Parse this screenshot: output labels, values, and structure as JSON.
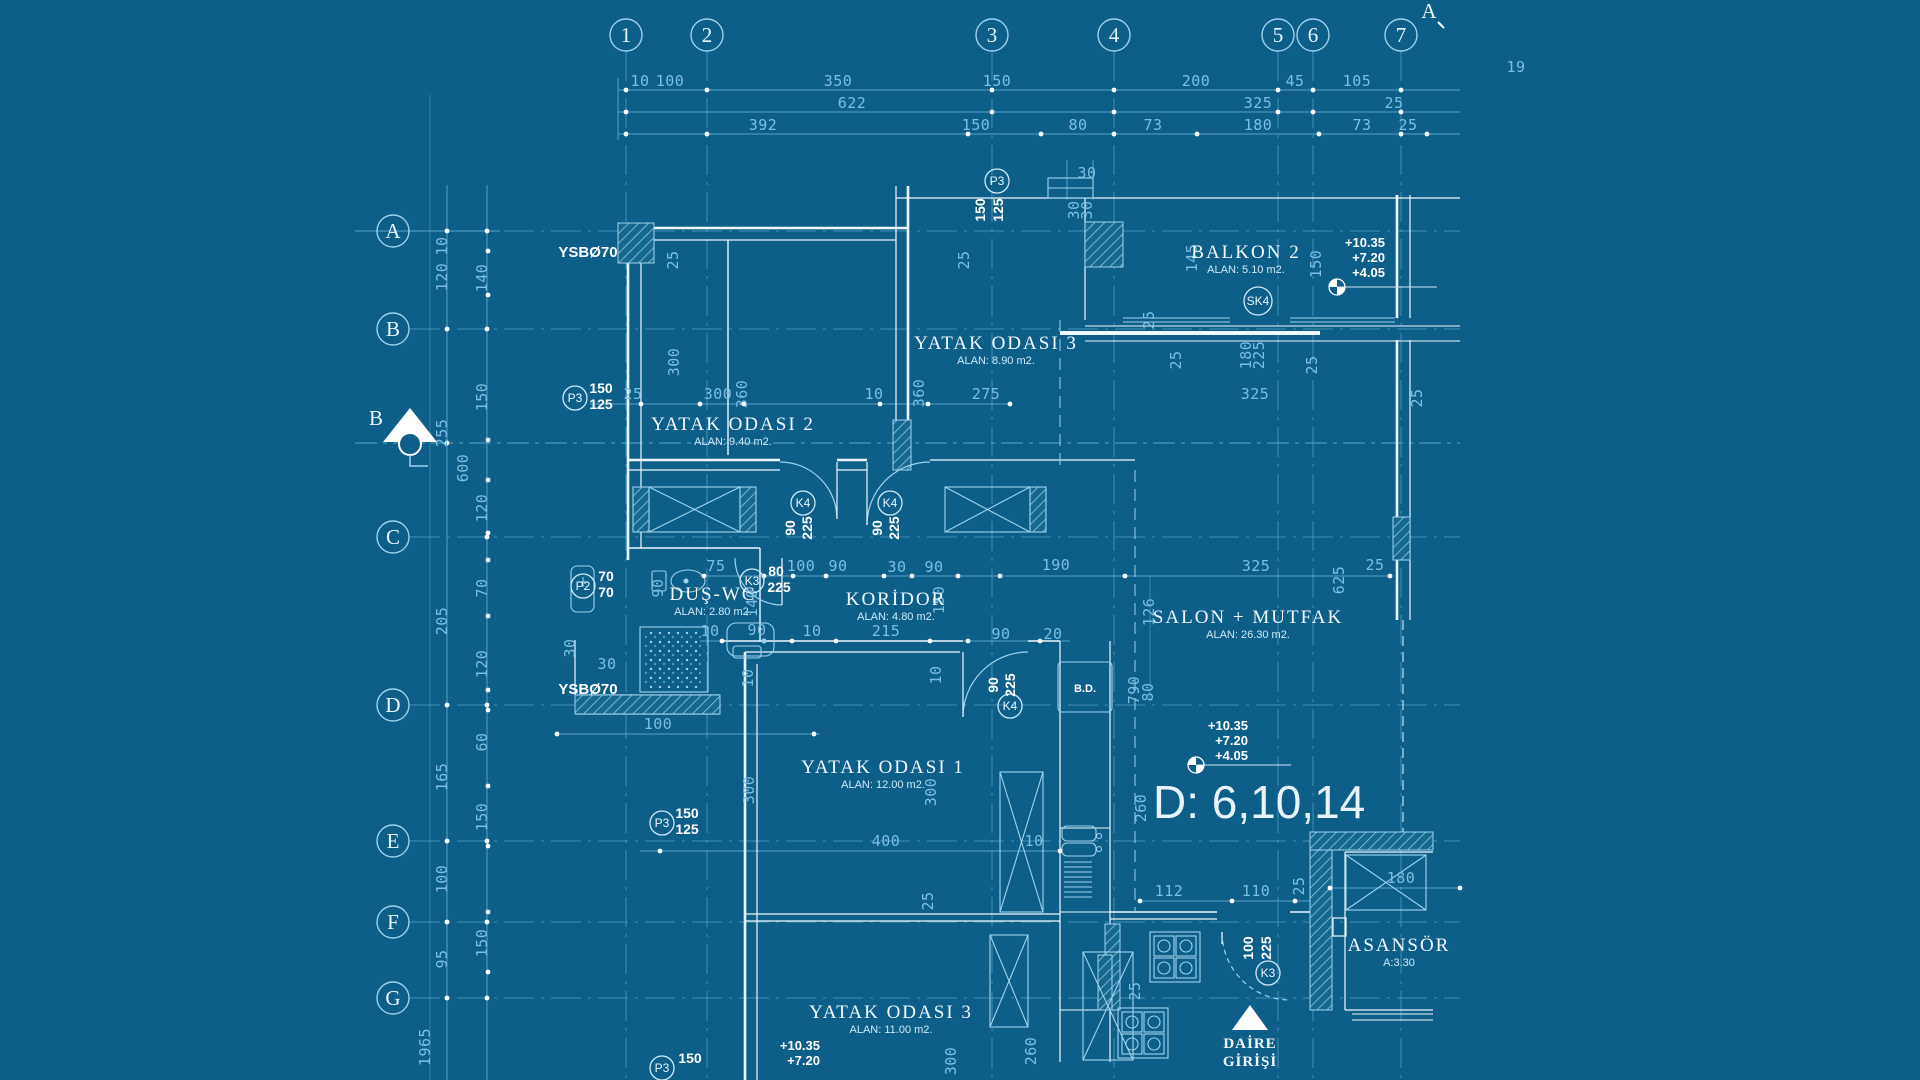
{
  "colors": {
    "background": "#0d5f8a",
    "pale_line": "#5fa8d0",
    "bright_line": "#9fd2ee",
    "wall": "#edf7ff",
    "dim_text": "#7cbee2",
    "label_text": "#f4faff",
    "hatch": "#8cc6e6"
  },
  "grid": {
    "columns": [
      {
        "label": "1",
        "x": 626
      },
      {
        "label": "2",
        "x": 707
      },
      {
        "label": "3",
        "x": 992
      },
      {
        "label": "4",
        "x": 1114
      },
      {
        "label": "5",
        "x": 1278
      },
      {
        "label": "6",
        "x": 1313
      },
      {
        "label": "7",
        "x": 1401
      }
    ],
    "rows": [
      {
        "label": "A",
        "y": 231
      },
      {
        "label": "B",
        "y": 329
      },
      {
        "label": "C",
        "y": 537
      },
      {
        "label": "D",
        "y": 705
      },
      {
        "label": "E",
        "y": 841
      },
      {
        "label": "F",
        "y": 922
      },
      {
        "label": "G",
        "y": 998
      }
    ]
  },
  "section_markers": [
    {
      "label": "B",
      "x": 383,
      "y": 422
    },
    {
      "label": "A",
      "x": 1429,
      "y": 14
    }
  ],
  "rooms": [
    {
      "name": "YATAK  ODASI 3",
      "area": "ALAN: 8.90 m2.",
      "x": 996,
      "y": 349
    },
    {
      "name": "YATAK  ODASI 2",
      "area": "ALAN: 9.40 m2.",
      "x": 733,
      "y": 430
    },
    {
      "name": "BALKON  2",
      "area": "ALAN: 5.10 m2.",
      "x": 1246,
      "y": 258
    },
    {
      "name": "DUŞ-WC",
      "area": "ALAN: 2.80 m2.",
      "x": 713,
      "y": 600
    },
    {
      "name": "KORİDOR",
      "area": "ALAN: 4.80 m2.",
      "x": 896,
      "y": 605
    },
    {
      "name": "SALON + MUTFAK",
      "area": "ALAN: 26.30 m2.",
      "x": 1248,
      "y": 623
    },
    {
      "name": "YATAK  ODASI 1",
      "area": "ALAN: 12.00 m2.",
      "x": 883,
      "y": 773
    },
    {
      "name": "YATAK  ODASI 3",
      "area": "ALAN: 11.00 m2.",
      "x": 891,
      "y": 1018
    },
    {
      "name": "ASANSÖR",
      "area": "A:3.30",
      "x": 1399,
      "y": 951
    }
  ],
  "tags": [
    {
      "label": "P3",
      "x": 997,
      "y": 181,
      "values": [
        {
          "t": "150",
          "x": 985,
          "y": 210,
          "r": -90
        },
        {
          "t": "125",
          "x": 1003,
          "y": 210,
          "r": -90
        }
      ]
    },
    {
      "label": "P3",
      "x": 575,
      "y": 398,
      "values": [
        {
          "t": "150",
          "x": 601,
          "y": 393,
          "r": 0
        },
        {
          "t": "125",
          "x": 601,
          "y": 409,
          "r": 0
        }
      ]
    },
    {
      "label": "P2",
      "x": 583,
      "y": 586,
      "values": [
        {
          "t": "70",
          "x": 606,
          "y": 581,
          "r": 0
        },
        {
          "t": "70",
          "x": 606,
          "y": 597,
          "r": 0
        }
      ]
    },
    {
      "label": "K3",
      "x": 752,
      "y": 581,
      "values": [
        {
          "t": "80",
          "x": 776,
          "y": 576,
          "r": 0
        },
        {
          "t": "225",
          "x": 779,
          "y": 592,
          "r": 0
        }
      ]
    },
    {
      "label": "K4",
      "x": 803,
      "y": 503,
      "values": [
        {
          "t": "90",
          "x": 795,
          "y": 528,
          "r": -90
        },
        {
          "t": "225",
          "x": 812,
          "y": 528,
          "r": -90
        }
      ]
    },
    {
      "label": "K4",
      "x": 890,
      "y": 503,
      "values": [
        {
          "t": "90",
          "x": 882,
          "y": 528,
          "r": -90
        },
        {
          "t": "225",
          "x": 899,
          "y": 528,
          "r": -90
        }
      ]
    },
    {
      "label": "K4",
      "x": 1010,
      "y": 706,
      "values": [
        {
          "t": "90",
          "x": 998,
          "y": 685,
          "r": -90
        },
        {
          "t": "225",
          "x": 1015,
          "y": 685,
          "r": -90
        }
      ]
    },
    {
      "label": "K3",
      "x": 1268,
      "y": 973,
      "values": [
        {
          "t": "100",
          "x": 1253,
          "y": 948,
          "r": -90
        },
        {
          "t": "225",
          "x": 1271,
          "y": 948,
          "r": -90
        }
      ]
    },
    {
      "label": "P3",
      "x": 662,
      "y": 823,
      "values": [
        {
          "t": "150",
          "x": 687,
          "y": 818,
          "r": 0
        },
        {
          "t": "125",
          "x": 687,
          "y": 834,
          "r": 0
        }
      ]
    },
    {
      "label": "P3",
      "x": 662,
      "y": 1068,
      "values": [
        {
          "t": "150",
          "x": 690,
          "y": 1063,
          "r": 0
        }
      ]
    },
    {
      "label": "SK4",
      "x": 1258,
      "y": 301,
      "values": []
    }
  ],
  "dim_labels": [
    {
      "t": "10",
      "x": 640,
      "y": 86
    },
    {
      "t": "100",
      "x": 670,
      "y": 86
    },
    {
      "t": "350",
      "x": 838,
      "y": 86
    },
    {
      "t": "150",
      "x": 997,
      "y": 86
    },
    {
      "t": "200",
      "x": 1196,
      "y": 86
    },
    {
      "t": "45",
      "x": 1295,
      "y": 86
    },
    {
      "t": "105",
      "x": 1357,
      "y": 86
    },
    {
      "t": "19",
      "x": 1516,
      "y": 72
    },
    {
      "t": "622",
      "x": 852,
      "y": 108
    },
    {
      "t": "325",
      "x": 1258,
      "y": 108
    },
    {
      "t": "25",
      "x": 1394,
      "y": 108
    },
    {
      "t": "392",
      "x": 763,
      "y": 130
    },
    {
      "t": "150",
      "x": 976,
      "y": 130
    },
    {
      "t": "80",
      "x": 1078,
      "y": 130
    },
    {
      "t": "73",
      "x": 1153,
      "y": 130
    },
    {
      "t": "180",
      "x": 1258,
      "y": 130
    },
    {
      "t": "73",
      "x": 1362,
      "y": 130
    },
    {
      "t": "25",
      "x": 1408,
      "y": 130
    },
    {
      "t": "10",
      "x": 447,
      "y": 246,
      "r": -90
    },
    {
      "t": "120",
      "x": 447,
      "y": 277,
      "r": -90
    },
    {
      "t": "255",
      "x": 447,
      "y": 433,
      "r": -90
    },
    {
      "t": "205",
      "x": 447,
      "y": 621,
      "r": -90
    },
    {
      "t": "165",
      "x": 447,
      "y": 777,
      "r": -90
    },
    {
      "t": "100",
      "x": 447,
      "y": 879,
      "r": -90
    },
    {
      "t": "95",
      "x": 447,
      "y": 959,
      "r": -90
    },
    {
      "t": "1965",
      "x": 430,
      "y": 1047,
      "r": -90
    },
    {
      "t": "140",
      "x": 487,
      "y": 278,
      "r": -90
    },
    {
      "t": "150",
      "x": 487,
      "y": 397,
      "r": -90
    },
    {
      "t": "120",
      "x": 487,
      "y": 508,
      "r": -90
    },
    {
      "t": "70",
      "x": 487,
      "y": 588,
      "r": -90
    },
    {
      "t": "120",
      "x": 487,
      "y": 664,
      "r": -90
    },
    {
      "t": "60",
      "x": 487,
      "y": 742,
      "r": -90
    },
    {
      "t": "150",
      "x": 487,
      "y": 817,
      "r": -90
    },
    {
      "t": "150",
      "x": 487,
      "y": 943,
      "r": -90
    },
    {
      "t": "600",
      "x": 468,
      "y": 468,
      "r": -90
    },
    {
      "t": "30",
      "x": 1087,
      "y": 178
    },
    {
      "t": "30",
      "x": 1079,
      "y": 210,
      "r": -90
    },
    {
      "t": "30",
      "x": 1092,
      "y": 210,
      "r": -90
    },
    {
      "t": "25",
      "x": 678,
      "y": 260,
      "r": -90
    },
    {
      "t": "25",
      "x": 969,
      "y": 260,
      "r": -90
    },
    {
      "t": "145",
      "x": 1197,
      "y": 258,
      "r": -90
    },
    {
      "t": "150",
      "x": 1321,
      "y": 264,
      "r": -90
    },
    {
      "t": "25",
      "x": 1154,
      "y": 320,
      "r": -90
    },
    {
      "t": "300",
      "x": 679,
      "y": 362,
      "r": -90
    },
    {
      "t": "180",
      "x": 1251,
      "y": 355,
      "r": -90
    },
    {
      "t": "225",
      "x": 1264,
      "y": 355,
      "r": -90
    },
    {
      "t": "25",
      "x": 1181,
      "y": 360,
      "r": -90
    },
    {
      "t": "25",
      "x": 1317,
      "y": 365,
      "r": -90
    },
    {
      "t": "25",
      "x": 633,
      "y": 399
    },
    {
      "t": "300",
      "x": 718,
      "y": 399
    },
    {
      "t": "360",
      "x": 747,
      "y": 394,
      "r": -90
    },
    {
      "t": "10",
      "x": 874,
      "y": 399
    },
    {
      "t": "360",
      "x": 924,
      "y": 393,
      "r": -90
    },
    {
      "t": "275",
      "x": 986,
      "y": 399
    },
    {
      "t": "325",
      "x": 1255,
      "y": 399
    },
    {
      "t": "25",
      "x": 1422,
      "y": 398,
      "r": -90
    },
    {
      "t": "75",
      "x": 716,
      "y": 571
    },
    {
      "t": "100",
      "x": 801,
      "y": 571
    },
    {
      "t": "90",
      "x": 838,
      "y": 571
    },
    {
      "t": "30",
      "x": 897,
      "y": 572
    },
    {
      "t": "90",
      "x": 934,
      "y": 572
    },
    {
      "t": "190",
      "x": 1056,
      "y": 570
    },
    {
      "t": "325",
      "x": 1256,
      "y": 571
    },
    {
      "t": "25",
      "x": 1375,
      "y": 570
    },
    {
      "t": "625",
      "x": 1344,
      "y": 580,
      "r": -90
    },
    {
      "t": "90",
      "x": 663,
      "y": 588,
      "r": -90
    },
    {
      "t": "150",
      "x": 944,
      "y": 600,
      "r": -90
    },
    {
      "t": "140",
      "x": 757,
      "y": 603,
      "r": -90
    },
    {
      "t": "10",
      "x": 710,
      "y": 636
    },
    {
      "t": "90",
      "x": 757,
      "y": 635
    },
    {
      "t": "10",
      "x": 812,
      "y": 636
    },
    {
      "t": "215",
      "x": 886,
      "y": 636
    },
    {
      "t": "30",
      "x": 575,
      "y": 648,
      "r": -90
    },
    {
      "t": "30",
      "x": 607,
      "y": 669
    },
    {
      "t": "100",
      "x": 658,
      "y": 729
    },
    {
      "t": "10",
      "x": 753,
      "y": 678,
      "r": -90
    },
    {
      "t": "10",
      "x": 941,
      "y": 675,
      "r": -90
    },
    {
      "t": "90",
      "x": 1001,
      "y": 639
    },
    {
      "t": "20",
      "x": 1053,
      "y": 639
    },
    {
      "t": "126",
      "x": 1154,
      "y": 612,
      "r": -90
    },
    {
      "t": "790",
      "x": 1139,
      "y": 690,
      "r": -90
    },
    {
      "t": "80",
      "x": 1153,
      "y": 692,
      "r": -90
    },
    {
      "t": "260",
      "x": 1146,
      "y": 808,
      "r": -90
    },
    {
      "t": "300",
      "x": 754,
      "y": 790,
      "r": -90
    },
    {
      "t": "300",
      "x": 936,
      "y": 792,
      "r": -90
    },
    {
      "t": "400",
      "x": 886,
      "y": 846
    },
    {
      "t": "10",
      "x": 1034,
      "y": 846
    },
    {
      "t": "25",
      "x": 933,
      "y": 901,
      "r": -90
    },
    {
      "t": "112",
      "x": 1169,
      "y": 896
    },
    {
      "t": "110",
      "x": 1256,
      "y": 896
    },
    {
      "t": "25",
      "x": 1304,
      "y": 886,
      "r": -90
    },
    {
      "t": "180",
      "x": 1401,
      "y": 883
    },
    {
      "t": "25",
      "x": 1140,
      "y": 991,
      "r": -90
    },
    {
      "t": "300",
      "x": 956,
      "y": 1061,
      "r": -90
    },
    {
      "t": "260",
      "x": 1036,
      "y": 1051,
      "r": -90
    }
  ],
  "notes": [
    {
      "t": "YSBØ70",
      "x": 588,
      "y": 257,
      "size": 15
    },
    {
      "t": "YSBØ70",
      "x": 588,
      "y": 694,
      "size": 15
    },
    {
      "t": "B.D.",
      "x": 1085,
      "y": 692,
      "size": 11
    }
  ],
  "serif_notes": [
    {
      "t": "DAİRE",
      "x": 1250,
      "y": 1048
    },
    {
      "t": "GİRİŞİ",
      "x": 1250,
      "y": 1066
    }
  ],
  "elevations": [
    {
      "lines": [
        "+10.35",
        "+7.20",
        "+4.05"
      ],
      "x": 1385,
      "y": 247,
      "mx": 1337,
      "my": 287,
      "len": 100
    },
    {
      "lines": [
        "+10.35",
        "+7.20",
        "+4.05"
      ],
      "x": 1248,
      "y": 730,
      "mx": 1196,
      "my": 765,
      "len": 95
    },
    {
      "lines": [
        "+10.35",
        "+7.20"
      ],
      "x": 820,
      "y": 1050,
      "mx": 0,
      "my": 0,
      "len": 0
    }
  ],
  "big_label": {
    "text": "D: 6,10,14"
  }
}
